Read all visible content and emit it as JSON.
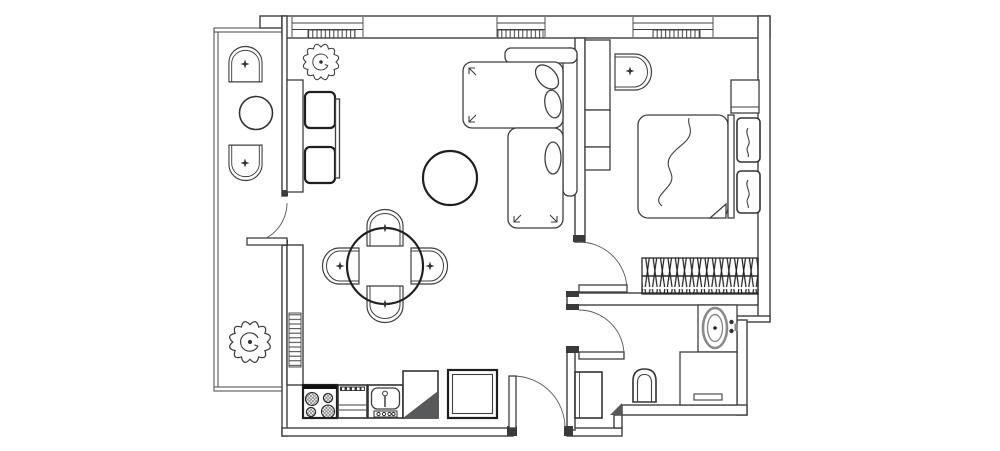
{
  "meta": {
    "title": "One-bedroom apartment floor plan",
    "canvas_width": 1000,
    "canvas_height": 451,
    "drawing_style": "black-and-white CAD top view, no text labels"
  },
  "palette": {
    "background": "#ffffff",
    "wall_line": "#3f3f3f",
    "furniture_line": "#1f1f1f",
    "poche_fill": "#58595b",
    "fixture_gray": "#8a8a8a"
  },
  "rooms": [
    {
      "id": "balcony",
      "label": "Balcony",
      "furniture": [
        "lounge chair",
        "round side table",
        "lounge chair",
        "potted plant"
      ]
    },
    {
      "id": "living-dining",
      "label": "Living / dining room",
      "furniture": [
        "wall desk",
        "desk chair x2",
        "desk panel",
        "potted plant",
        "L-shaped sofa",
        "throw cushions x3",
        "round coffee table",
        "round dining table",
        "dining chair x4",
        "wall radiator"
      ]
    },
    {
      "id": "kitchen",
      "label": "Kitchen row",
      "furniture": [
        "4-burner cooktop",
        "oven",
        "kitchen sink",
        "corner cabinet with poche",
        "refrigerator"
      ]
    },
    {
      "id": "hallway",
      "label": "Entry hall",
      "furniture": [
        "entry door",
        "hall closet"
      ]
    },
    {
      "id": "bedroom",
      "label": "Bedroom",
      "furniture": [
        "shelving column",
        "armchair",
        "double bed",
        "pillow x2",
        "nightstand",
        "hanging wardrobe rail"
      ]
    },
    {
      "id": "bathroom",
      "label": "Bathroom",
      "furniture": [
        "washbasin with counter",
        "washing machine",
        "toilet",
        "tall cabinet"
      ]
    }
  ],
  "openings": {
    "windows": [
      {
        "id": "living-window-1",
        "radiator_below": true
      },
      {
        "id": "living-window-2",
        "radiator_below": true
      },
      {
        "id": "bedroom-window",
        "radiator_below": true
      }
    ],
    "doors": [
      {
        "id": "entry-door",
        "swing": "into hall"
      },
      {
        "id": "balcony-door",
        "swing": "onto balcony"
      },
      {
        "id": "bedroom-door",
        "swing": "into bedroom"
      },
      {
        "id": "bathroom-door",
        "swing": "into bathroom"
      }
    ]
  },
  "accessibility": {
    "caption": "Black-and-white architectural floor plan of a one-bedroom apartment: balcony on the left, open living-dining room with kitchen row at the bottom, entry hall, bedroom at top right and bathroom at bottom right."
  }
}
